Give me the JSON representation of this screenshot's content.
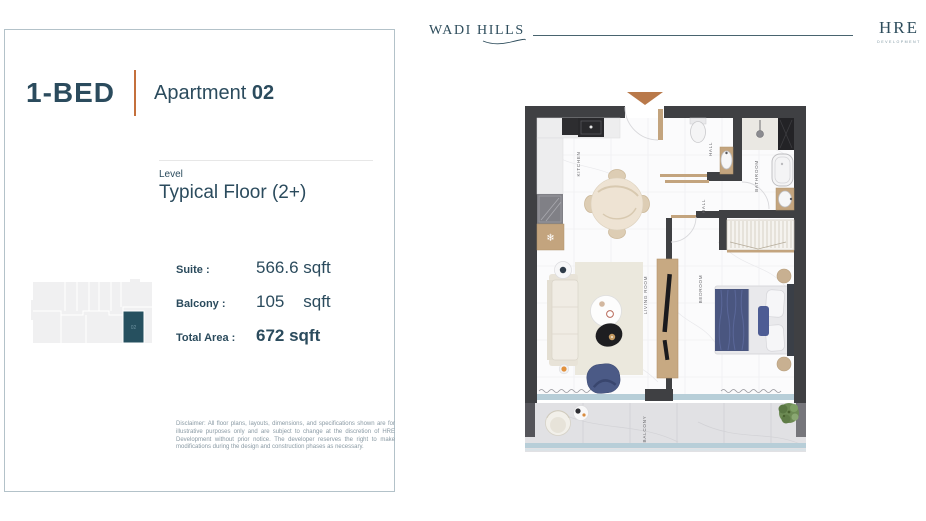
{
  "header": {
    "brand": "WADI HILLS",
    "developer": {
      "name": "HRE",
      "sub": "DEVELOPMENT"
    }
  },
  "card": {
    "unit_type": "1-BED",
    "apartment_label": "Apartment",
    "apartment_number": "02",
    "level_label": "Level",
    "level_value": "Typical Floor (2+)",
    "areas": [
      {
        "label": "Suite :",
        "value": "566.6 sqft"
      },
      {
        "label": "Balcony :",
        "value": "105    sqft"
      },
      {
        "label": "Total Area :",
        "value": "672 sqft"
      }
    ],
    "keyplan": {
      "unit_label": "02",
      "highlight_color": "#26505f"
    },
    "disclaimer": "Disclaimer: All floor plans, layouts, dimensions, and specifications shown are for illustrative purposes only and are subject to change at the discretion of HRE Development without prior notice. The developer reserves the right to make modifications during the design and construction phases as necessary."
  },
  "floorplan": {
    "labels": {
      "kitchen": "KITCHEN",
      "hall_upper": "HALL",
      "hall_lower": "HALL",
      "bathroom": "BATHROOM",
      "living": "LIVING ROOM",
      "bedroom": "BEDROOM",
      "balcony": "BALCONY"
    },
    "icons": {
      "freezer": "❄"
    },
    "colors": {
      "wall": "#3f4043",
      "wood": "#c3a47e",
      "entry_arrow": "#b9794a",
      "glass": "#b7ced8",
      "accent_navy": "#4a5680",
      "text_teal": "#2b4b5d",
      "divider_orange": "#c4703c"
    }
  }
}
